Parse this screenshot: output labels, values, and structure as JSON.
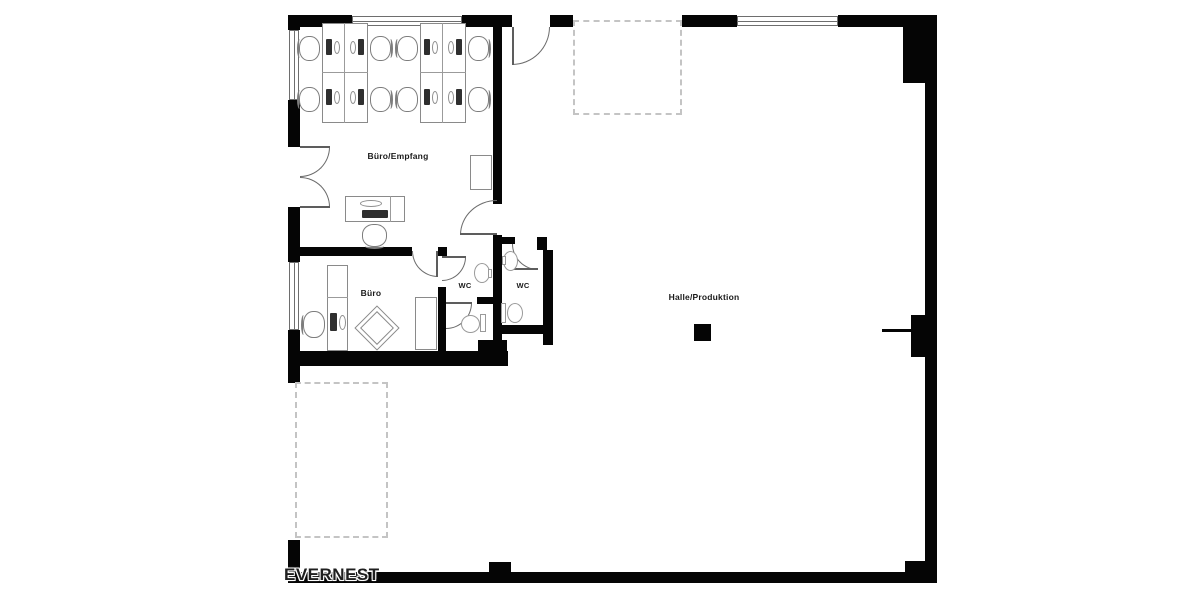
{
  "plan": {
    "title": "floor-plan",
    "watermark": "EVERNEST",
    "rooms": [
      {
        "name": "buero-empfang",
        "label": "Büro/Empfang"
      },
      {
        "name": "buero",
        "label": "Büro"
      },
      {
        "name": "wc-left",
        "label": "WC"
      },
      {
        "name": "wc-right",
        "label": "WC"
      },
      {
        "name": "halle-produktion",
        "label": "Halle/Produktion"
      }
    ],
    "colors": {
      "wall": "#050505",
      "furniture_line": "#8a8a8a",
      "door_line": "#6b6b6b",
      "dashed_line": "#c4c4c4",
      "label_text": "#1a1a1a",
      "watermark_text": "#1f1f1f"
    }
  }
}
